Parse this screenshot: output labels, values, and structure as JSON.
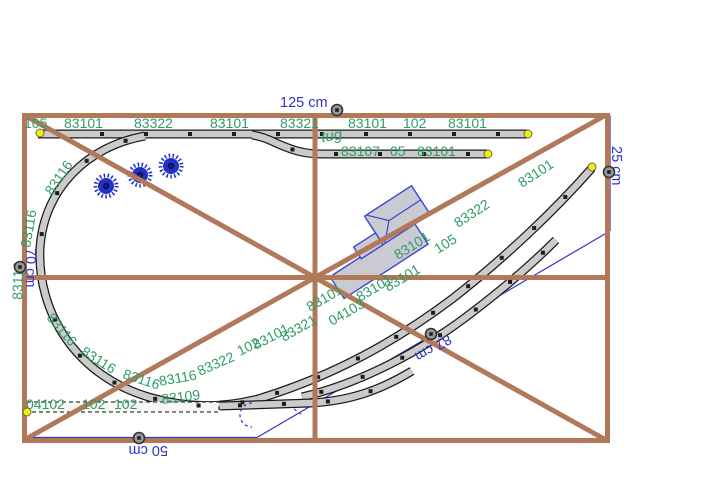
{
  "app": {
    "description": "Model railway track plan editor canvas with baseboard frame, track pieces, part-number labels and dimension measurements"
  },
  "palette": {
    "bg": "#ffffff",
    "frame_brown": "#b1795a",
    "track_fill": "#cbcbcb",
    "track_stroke": "#1a1a1a",
    "label_green": "#2f9c64",
    "dimension_blue": "#3233cc",
    "tree_blue": "#2231c6",
    "tree_core": "#0a1160",
    "end_yellow": "#f2f200",
    "handle_gray": "#9a9a9a",
    "building_fill": "#c9cad2",
    "building_stroke": "#3a46d4"
  },
  "dimensions": [
    {
      "t": "125 cm",
      "x": 280,
      "y": 107,
      "r": 0
    },
    {
      "t": "25 cm",
      "x": 612,
      "y": 146,
      "r": 90
    },
    {
      "t": "87 cm",
      "x": 448,
      "y": 334,
      "r": 150
    },
    {
      "t": "50 cm",
      "x": 168,
      "y": 446,
      "r": 180
    },
    {
      "t": "70 cm",
      "x": 26,
      "y": 248,
      "r": 90
    }
  ],
  "track_labels": [
    {
      "t": "105",
      "x": 24,
      "y": 128,
      "r": 0
    },
    {
      "t": "83101",
      "x": 64,
      "y": 128,
      "r": 0
    },
    {
      "t": "83322",
      "x": 134,
      "y": 128,
      "r": 0
    },
    {
      "t": "83101",
      "x": 210,
      "y": 128,
      "r": 0
    },
    {
      "t": "83321",
      "x": 280,
      "y": 128,
      "r": 0
    },
    {
      "t": "83101",
      "x": 348,
      "y": 128,
      "r": 0
    },
    {
      "t": "102",
      "x": 403,
      "y": 128,
      "r": 0
    },
    {
      "t": "83101",
      "x": 448,
      "y": 128,
      "r": 0
    },
    {
      "t": "tug",
      "x": 322,
      "y": 142,
      "r": -8,
      "style": "italic"
    },
    {
      "t": "83107",
      "x": 341,
      "y": 156,
      "r": 0
    },
    {
      "t": "05",
      "x": 390,
      "y": 156,
      "r": 0
    },
    {
      "t": "83101",
      "x": 417,
      "y": 156,
      "r": 0
    },
    {
      "t": "83116",
      "x": 52,
      "y": 196,
      "r": -56
    },
    {
      "t": "83116",
      "x": 30,
      "y": 248,
      "r": -80
    },
    {
      "t": "83116",
      "x": 22,
      "y": 300,
      "r": -88
    },
    {
      "t": "83116",
      "x": 46,
      "y": 318,
      "r": 50
    },
    {
      "t": "83116",
      "x": 80,
      "y": 354,
      "r": 32
    },
    {
      "t": "83116",
      "x": 122,
      "y": 378,
      "r": 18
    },
    {
      "t": "83116",
      "x": 160,
      "y": 386,
      "r": -10
    },
    {
      "t": "83322",
      "x": 200,
      "y": 376,
      "r": -24
    },
    {
      "t": "102",
      "x": 240,
      "y": 356,
      "r": -26
    },
    {
      "t": "83101",
      "x": 256,
      "y": 350,
      "r": -28
    },
    {
      "t": "83321",
      "x": 284,
      "y": 342,
      "r": -30
    },
    {
      "t": "83101",
      "x": 310,
      "y": 312,
      "r": -30
    },
    {
      "t": "04103",
      "x": 332,
      "y": 326,
      "r": -30
    },
    {
      "t": "83101",
      "x": 360,
      "y": 302,
      "r": -31
    },
    {
      "t": "83101",
      "x": 388,
      "y": 292,
      "r": -31
    },
    {
      "t": "83101",
      "x": 398,
      "y": 260,
      "r": -32
    },
    {
      "t": "105",
      "x": 438,
      "y": 254,
      "r": -32
    },
    {
      "t": "83322",
      "x": 458,
      "y": 228,
      "r": -33
    },
    {
      "t": "83101",
      "x": 522,
      "y": 188,
      "r": -33
    },
    {
      "t": "04102",
      "x": 26,
      "y": 409,
      "r": 0
    },
    {
      "t": "102",
      "x": 82,
      "y": 409,
      "r": 0
    },
    {
      "t": "102",
      "x": 114,
      "y": 409,
      "r": 0
    },
    {
      "t": "83109",
      "x": 162,
      "y": 404,
      "r": -7
    }
  ],
  "trees": [
    {
      "x": 106,
      "y": 186
    },
    {
      "x": 140,
      "y": 175
    },
    {
      "x": 171,
      "y": 166
    }
  ],
  "track_end_markers": [
    {
      "x": 40,
      "y": 133
    },
    {
      "x": 528,
      "y": 134
    },
    {
      "x": 488,
      "y": 154
    },
    {
      "x": 592,
      "y": 167
    },
    {
      "x": 27,
      "y": 412
    }
  ],
  "dimension_handles": [
    {
      "x": 337,
      "y": 110
    },
    {
      "x": 609,
      "y": 172
    },
    {
      "x": 431,
      "y": 334
    },
    {
      "x": 139,
      "y": 438
    },
    {
      "x": 20,
      "y": 267
    }
  ]
}
